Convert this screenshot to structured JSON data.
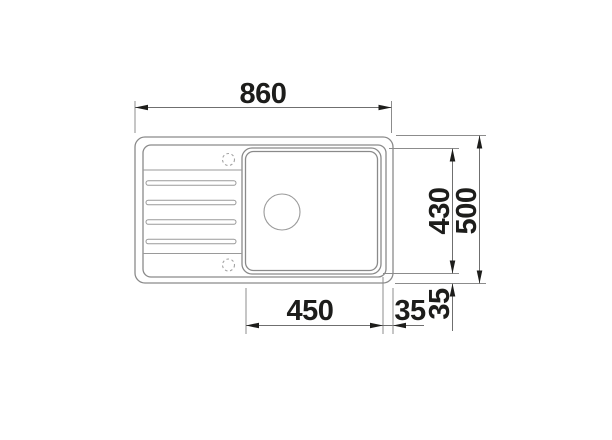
{
  "dimensions": {
    "overall_width": "860",
    "overall_depth": "500",
    "bowl_depth": "430",
    "bowl_width": "450",
    "gap_bowl_to_edge_right": "35",
    "gap_bowl_to_edge_bottom": "35"
  },
  "colors": {
    "background": "#ffffff",
    "sink_outline": "#8a8a8a",
    "detail_line": "#9a9a9a",
    "dimension_line": "#6f6f6f",
    "arrow_and_text": "#1d1d1b"
  }
}
